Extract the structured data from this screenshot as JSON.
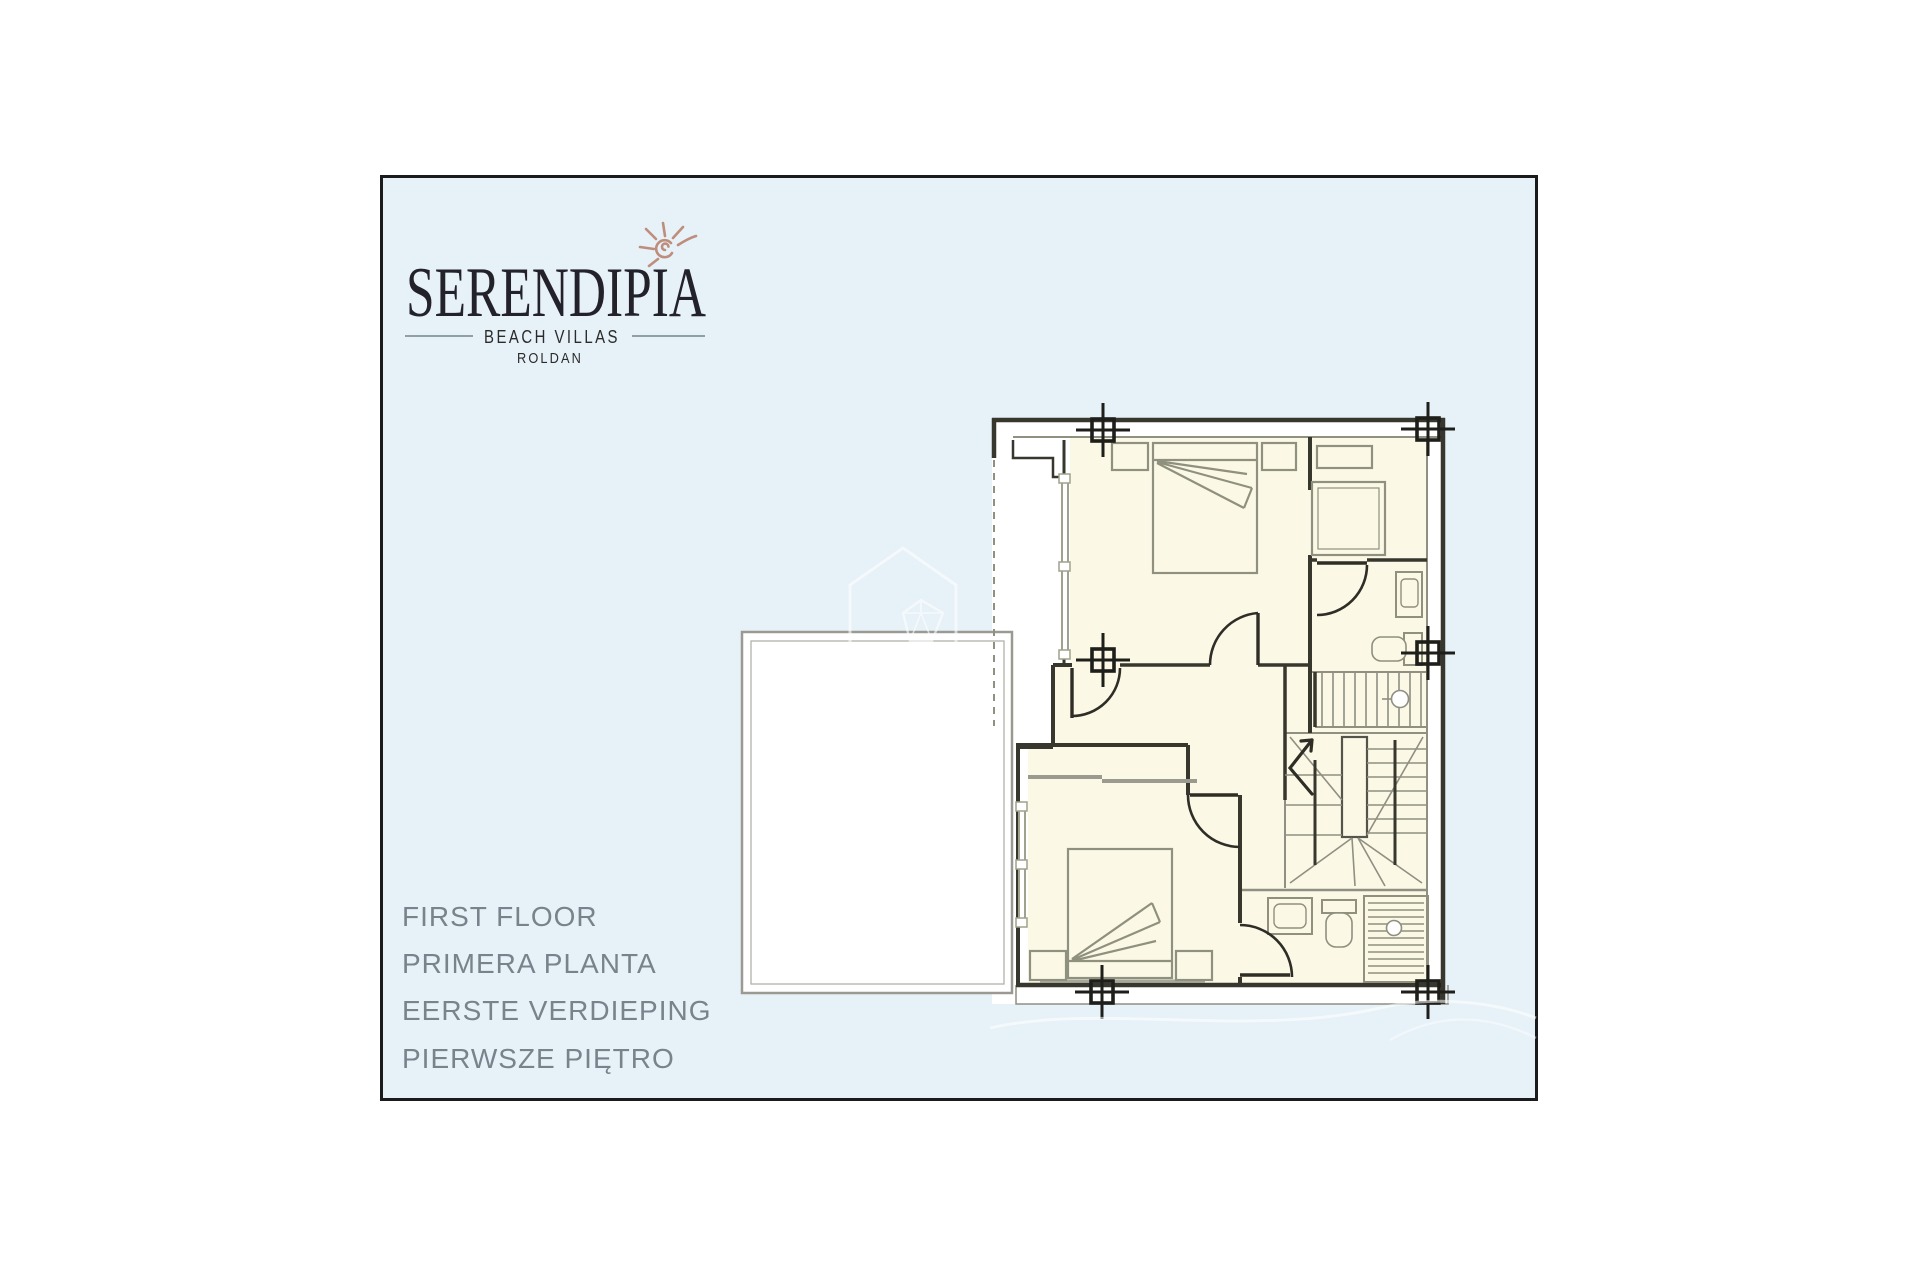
{
  "logo": {
    "name": "SERENDIPIA",
    "tagline": "BEACH VILLAS",
    "location": "ROLDAN",
    "icon": "sun-icon",
    "accent_color": "#bf8d7c",
    "text_color": "#23222b",
    "tagline_rule_color": "#8fa0a8"
  },
  "floor_labels": [
    "FIRST FLOOR",
    "PRIMERA PLANTA",
    "EERSTE VERDIEPING",
    "PIERWSZE PIĘTRO"
  ],
  "floor_labels_color": "#7a838b",
  "panel": {
    "background": "#e6f1f8",
    "border_color": "#1b1b1b",
    "outside_background": "#ffffff"
  },
  "floor_plan": {
    "room_fill": "#fbf8e6",
    "wall_color": "#38372e",
    "thin_line_color": "#8f8f82",
    "furniture_line_color": "#90907f",
    "window_line_color": "#9fa28c",
    "watermark_color": "#ffffff",
    "features": [
      "double-bed",
      "nightstand",
      "pillow-fan",
      "wardrobe",
      "closet",
      "staircase",
      "stair-direction-arrow",
      "door-swing",
      "window",
      "washbasin",
      "toilet",
      "walk-in-shower",
      "column-marker",
      "terrace",
      "watermark-house-gem",
      "decorative-swirl"
    ]
  }
}
